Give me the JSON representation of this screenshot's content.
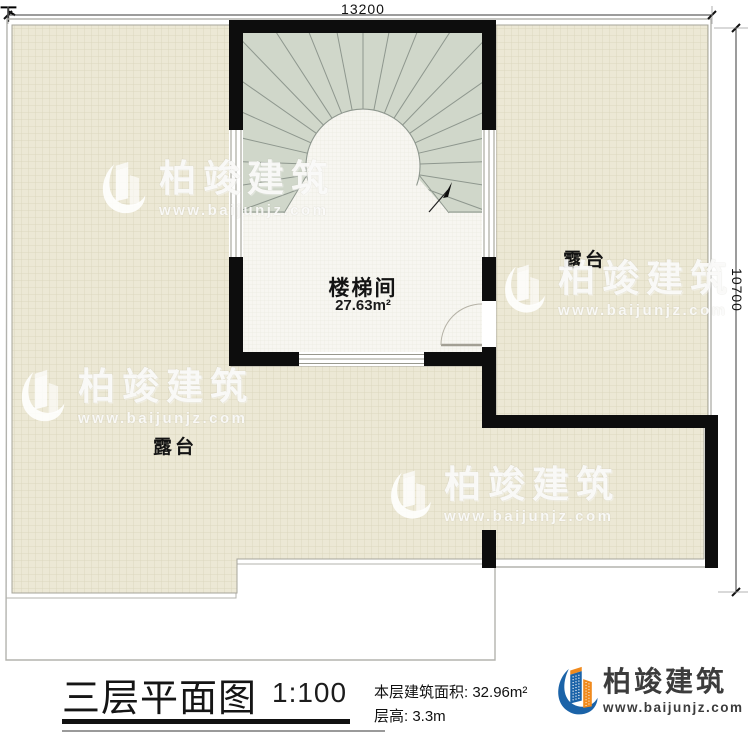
{
  "plan": {
    "dimension_top": "13200",
    "dimension_right": "10700",
    "stair_room": {
      "name": "楼梯间",
      "area": "27.63m²"
    },
    "terrace_right_label": "露台",
    "terrace_bottom_label": "露台",
    "stair_direction_label": "下"
  },
  "title_block": {
    "title": "三层平面图",
    "scale": "1:100",
    "floor_area": "本层建筑面积: 32.96m²",
    "floor_height": "层高: 3.3m"
  },
  "brand": {
    "name": "柏竣建筑",
    "website": "www.baijunjz.com"
  },
  "watermark": {
    "name": "柏竣建筑",
    "website": "www.baijunjz.com"
  },
  "colors": {
    "wall": "#0d0d0d",
    "terrace_fill": "#ece8d5",
    "terrace_grid_line": "#dcd7be",
    "room_fill": "#f7f6f1",
    "stair_fill": "#d0d7ca",
    "logo_blue": "#1b63a8",
    "logo_orange": "#f08a1d",
    "brand_text": "#3c3c3c"
  }
}
